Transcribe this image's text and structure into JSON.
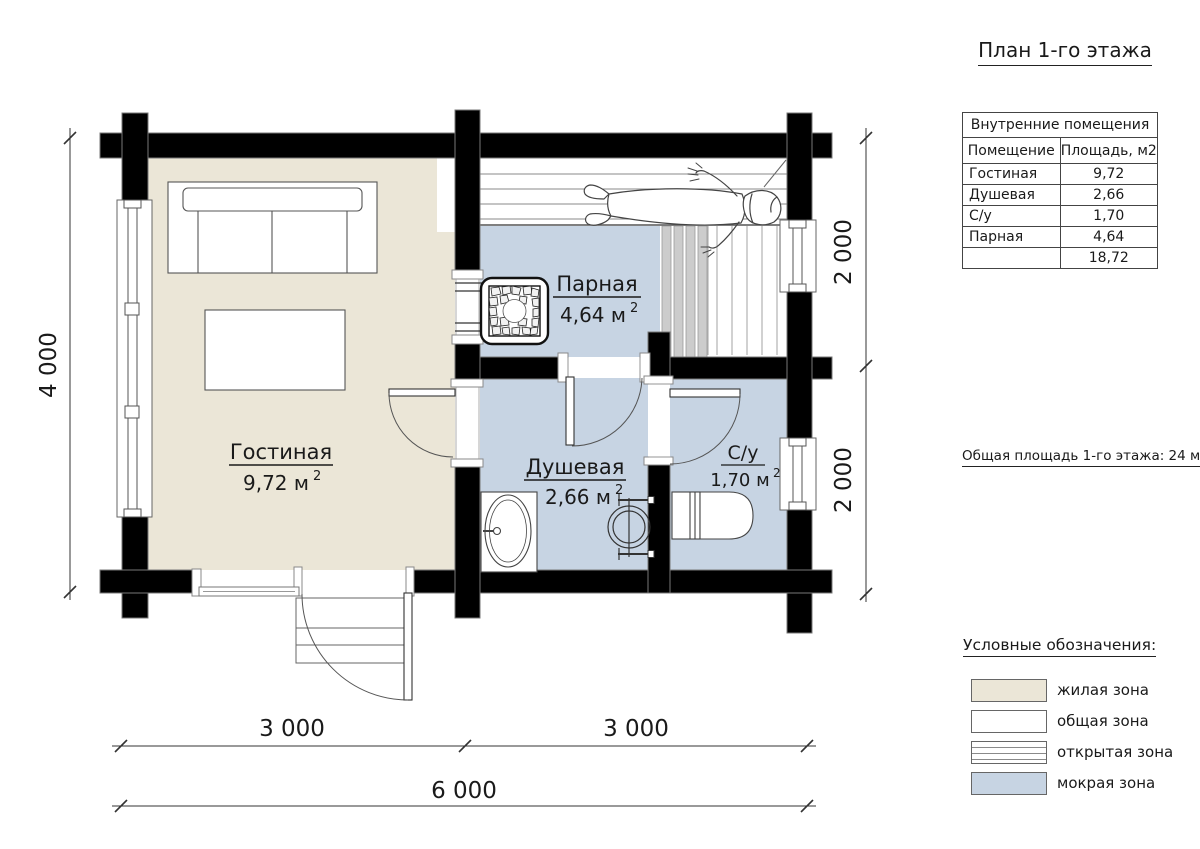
{
  "title": "План 1-го этажа",
  "rooms_table": {
    "caption": "Внутренние помещения",
    "col_room": "Помещение",
    "col_area": "Площадь, м2",
    "rows": [
      {
        "name": "Гостиная",
        "area": "9,72"
      },
      {
        "name": "Душевая",
        "area": "2,66"
      },
      {
        "name": "С/у",
        "area": "1,70"
      },
      {
        "name": "Парная",
        "area": "4,64"
      }
    ],
    "total": "18,72"
  },
  "total_area_note": "Общая площадь 1-го этажа: 24 м2",
  "legend": {
    "title": "Условные обозначения:",
    "items": [
      {
        "label": "жилая зона",
        "color": "#ebe6d7",
        "pattern": "solid"
      },
      {
        "label": "общая зона",
        "color": "#ffffff",
        "pattern": "solid"
      },
      {
        "label": "открытая зона",
        "color": "#ffffff",
        "pattern": "hlines"
      },
      {
        "label": "мокрая зона",
        "color": "#c7d4e3",
        "pattern": "solid"
      }
    ]
  },
  "plan": {
    "rooms": {
      "living": {
        "name": "Гостиная",
        "area_label": "9,72 м",
        "sup": "2"
      },
      "steam": {
        "name": "Парная",
        "area_label": "4,64 м",
        "sup": "2"
      },
      "shower": {
        "name": "Душевая",
        "area_label": "2,66 м",
        "sup": "2"
      },
      "wc": {
        "name": "С/у",
        "area_label": "1,70 м",
        "sup": "2"
      }
    },
    "dimensions": {
      "left": "4 000",
      "right_top": "2 000",
      "right_bottom": "2 000",
      "bottom_left": "3 000",
      "bottom_right": "3 000",
      "bottom_total": "6 000"
    }
  },
  "colors": {
    "wall": "#000000",
    "living_floor": "#ebe6d7",
    "wet_floor": "#c7d4e3",
    "slat_grey": "#cccccc"
  }
}
